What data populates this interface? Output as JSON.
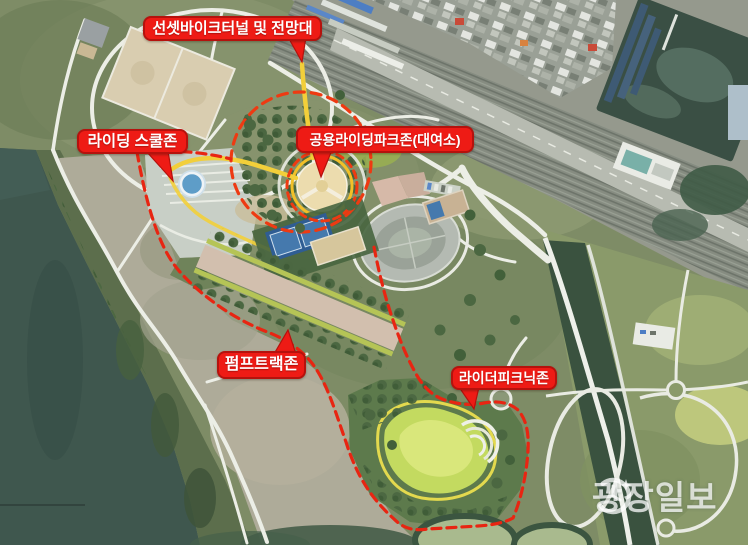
{
  "labels": [
    {
      "id": "sunset-bike-tunnel",
      "text": "선셋바이크터널 및 전망대"
    },
    {
      "id": "riding-school-zone",
      "text": "라이딩 스쿨존"
    },
    {
      "id": "public-riding-park-zone",
      "text": "공용라이딩파크존(대여소)"
    },
    {
      "id": "pump-track-zone",
      "text": "펌프트랙존"
    },
    {
      "id": "rider-picnic-zone",
      "text": "라이더피크닉존"
    }
  ],
  "watermark": {
    "text": "광장일보"
  },
  "colors": {
    "annotation_red": "#ee1b15",
    "annotation_border_red": "#b5120d",
    "boundary_dash_red": "#e82512",
    "zone_ring_orange_red": "#ee3a12",
    "route_yellow": "#f2cf3a",
    "plaza_ring_yellow": "#f2c028",
    "water_teal": "#3f574e",
    "park_green": "#7e8c66",
    "picnic_meadow_green": "#c3da60",
    "court_blue": "#2f5d93"
  }
}
